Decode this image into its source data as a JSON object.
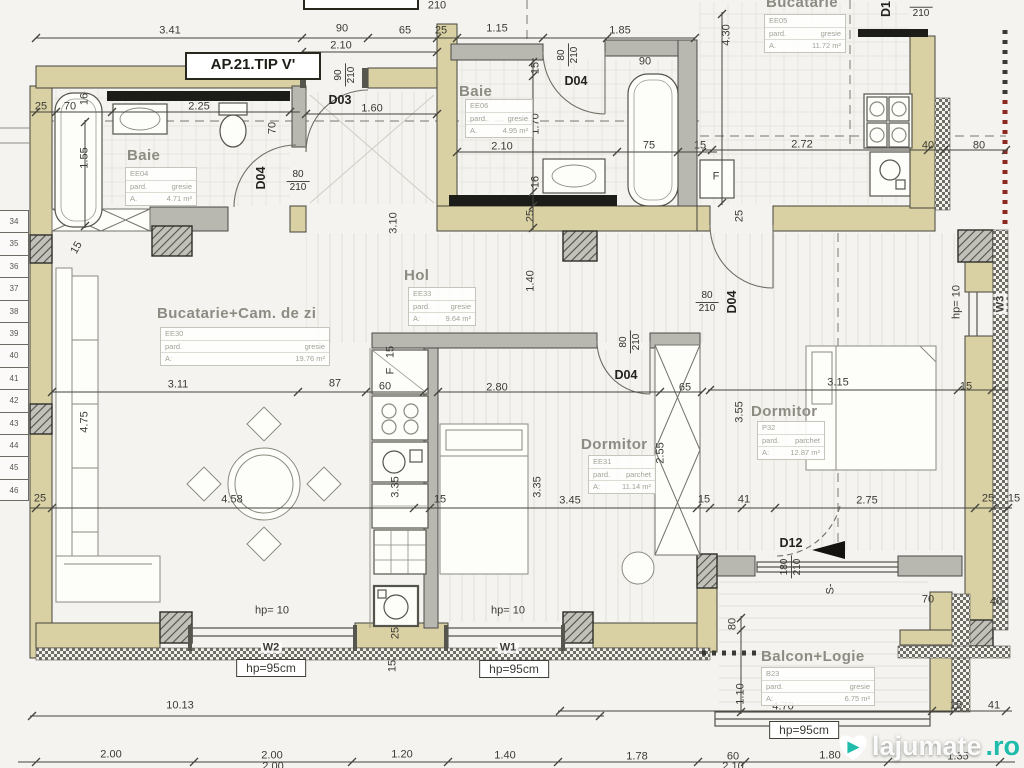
{
  "title": "AP.21.TIP V'",
  "watermark": {
    "name": "lajumate",
    "tld": ".ro"
  },
  "colors": {
    "wall_fill": "#d9d1a3",
    "line": "#44433c",
    "boundary_red": "#8d2721",
    "watermark_teal": "#1fbcab",
    "counter_black": "#1c1c18"
  },
  "rooms": [
    {
      "name": "Baie",
      "code": "EE04",
      "finish_label": "pard.",
      "finish": "gresie",
      "area_label": "A.",
      "area": "4.71 m²",
      "name_x": 127,
      "name_y": 147,
      "box_x": 125,
      "box_y": 167,
      "box_w": 70
    },
    {
      "name": "Baie",
      "code": "EE06",
      "finish_label": "pard.",
      "finish": "gresie",
      "area_label": "A.",
      "area": "4.95 m²",
      "name_x": 459,
      "name_y": 83,
      "box_x": 465,
      "box_y": 99,
      "box_w": 66
    },
    {
      "name": "Bucatarie",
      "code": "EE05",
      "finish_label": "pard.",
      "finish": "gresie",
      "area_label": "A.",
      "area": "11.72 m²",
      "name_x": 766,
      "name_y": -6,
      "box_x": 764,
      "box_y": 14,
      "box_w": 80
    },
    {
      "name": "Bucatarie+Cam. de zi",
      "code": "EE30",
      "finish_label": "pard.",
      "finish": "gresie",
      "area_label": "A:",
      "area": "19.76 m²",
      "name_x": 157,
      "name_y": 305,
      "box_x": 160,
      "box_y": 327,
      "box_w": 168
    },
    {
      "name": "Hol",
      "code": "EE33",
      "finish_label": "pard.",
      "finish": "gresie",
      "area_label": "A:",
      "area": "9.64 m²",
      "name_x": 404,
      "name_y": 267,
      "box_x": 408,
      "box_y": 287,
      "box_w": 66
    },
    {
      "name": "Dormitor",
      "code": "EE31",
      "finish_label": "pard.",
      "finish": "parchet",
      "area_label": "A:",
      "area": "11.14 m²",
      "name_x": 581,
      "name_y": 436,
      "box_x": 588,
      "box_y": 455,
      "box_w": 66
    },
    {
      "name": "Dormitor",
      "code": "P32",
      "finish_label": "pard.",
      "finish": "parchet",
      "area_label": "A:",
      "area": "12.87 m²",
      "name_x": 751,
      "name_y": 403,
      "box_x": 757,
      "box_y": 421,
      "box_w": 66
    },
    {
      "name": "Balcon+Logie",
      "code": "B23",
      "finish_label": "pard.",
      "finish": "gresie",
      "area_label": "A:",
      "area": "6.75 m²",
      "name_x": 761,
      "name_y": 648,
      "box_x": 761,
      "box_y": 667,
      "box_w": 112
    }
  ],
  "doors": [
    {
      "id": "D03",
      "size": "90/210",
      "label_x": 340,
      "label_y": 100,
      "label_r": 0,
      "frac_x": 345,
      "frac_y": 75,
      "frac_r": -90
    },
    {
      "id": "D04",
      "size": "80/210",
      "label_x": 261,
      "label_y": 178,
      "label_r": -90,
      "frac_x": 298,
      "frac_y": 181,
      "frac_r": 0
    },
    {
      "id": "D04",
      "size": "80/210",
      "label_x": 576,
      "label_y": 81,
      "label_r": 0,
      "frac_x": 568,
      "frac_y": 55,
      "frac_r": -90
    },
    {
      "id": "D04",
      "size": "80/210",
      "label_x": 626,
      "label_y": 375,
      "label_r": 0,
      "frac_x": 630,
      "frac_y": 342,
      "frac_r": -90
    },
    {
      "id": "D04",
      "size": "80/210",
      "label_x": 732,
      "label_y": 302,
      "label_r": -90,
      "frac_x": 707,
      "frac_y": 302,
      "frac_r": 0
    },
    {
      "id": "D12",
      "size": "180/210",
      "label_x": 791,
      "label_y": 543,
      "label_r": 0,
      "frac_x": 791,
      "frac_y": 567,
      "frac_r": -90
    },
    {
      "id": "D1",
      "size": "210",
      "label_x": 886,
      "label_y": 9,
      "label_r": -90,
      "frac_x": 921,
      "frac_y": 8,
      "frac_r": 0
    }
  ],
  "dims": [
    [
      "3.41",
      170,
      31
    ],
    [
      "90",
      342,
      29
    ],
    [
      "2.10",
      341,
      46
    ],
    [
      "65",
      405,
      31
    ],
    [
      "25",
      441,
      31
    ],
    [
      "1.15",
      497,
      29
    ],
    [
      "1.85",
      620,
      31
    ],
    [
      "210",
      437,
      6
    ],
    [
      "4.30",
      727,
      35,
      -90
    ],
    [
      "25",
      41,
      107
    ],
    [
      "70",
      70,
      107
    ],
    [
      "16",
      85,
      99,
      -90
    ],
    [
      "2.25",
      199,
      107
    ],
    [
      "70",
      273,
      128,
      -90
    ],
    [
      "1.60",
      372,
      109
    ],
    [
      "1.55",
      85,
      158,
      -90
    ],
    [
      "3.10",
      394,
      223,
      -90
    ],
    [
      "15",
      536,
      68,
      -90
    ],
    [
      "90",
      645,
      62
    ],
    [
      "1.70",
      536,
      124,
      -90
    ],
    [
      "2.10",
      502,
      147
    ],
    [
      "75",
      649,
      146
    ],
    [
      "15",
      700,
      146
    ],
    [
      "16",
      536,
      182,
      -90
    ],
    [
      "25",
      531,
      216,
      -90
    ],
    [
      "F",
      716,
      177
    ],
    [
      "25",
      740,
      216,
      -90
    ],
    [
      "2.72",
      802,
      145
    ],
    [
      "40",
      928,
      146
    ],
    [
      "80",
      979,
      146
    ],
    [
      "1.40",
      531,
      281,
      -90
    ],
    [
      "3.11",
      178,
      385
    ],
    [
      "87",
      335,
      384
    ],
    [
      "60",
      385,
      387
    ],
    [
      "15",
      391,
      352,
      -90
    ],
    [
      "F",
      391,
      371,
      -90
    ],
    [
      "2.80",
      497,
      388
    ],
    [
      "65",
      685,
      388
    ],
    [
      "3.15",
      838,
      383
    ],
    [
      "15",
      966,
      387
    ],
    [
      "3.55",
      740,
      412,
      -90
    ],
    [
      "2.55",
      661,
      453,
      -90
    ],
    [
      "4.75",
      85,
      422,
      -90
    ],
    [
      "15",
      77,
      248,
      -60
    ],
    [
      "25",
      40,
      499
    ],
    [
      "4.58",
      232,
      500
    ],
    [
      "3.35",
      396,
      487,
      -90
    ],
    [
      "15",
      440,
      500
    ],
    [
      "3.35",
      538,
      487,
      -90
    ],
    [
      "3.45",
      570,
      501
    ],
    [
      "15",
      704,
      500
    ],
    [
      "41",
      744,
      500
    ],
    [
      "2.75",
      867,
      501
    ],
    [
      "25",
      988,
      499
    ],
    [
      "15",
      1014,
      499
    ],
    [
      "hp= 10",
      272,
      611
    ],
    [
      "hp= 10",
      508,
      611
    ],
    [
      "hp= 10",
      957,
      302,
      -90
    ],
    [
      "70",
      928,
      600
    ],
    [
      "40",
      996,
      602
    ],
    [
      "S-",
      831,
      589,
      -90
    ],
    [
      "80",
      733,
      624,
      -90
    ],
    [
      "1.10",
      741,
      694,
      -90
    ],
    [
      "4.70",
      783,
      707
    ],
    [
      "15",
      956,
      706
    ],
    [
      "41",
      994,
      706
    ],
    [
      "25",
      396,
      633,
      -90
    ],
    [
      "15",
      393,
      666,
      -90
    ],
    [
      "10.13",
      180,
      706
    ],
    [
      "2.00",
      111,
      755
    ],
    [
      "2.00",
      272,
      756
    ],
    [
      "1.20",
      402,
      755
    ],
    [
      "1.40",
      505,
      756
    ],
    [
      "1.78",
      637,
      757
    ],
    [
      "60",
      733,
      757
    ],
    [
      "1.80",
      830,
      756
    ],
    [
      "1.35",
      958,
      757
    ],
    [
      "2.00",
      273,
      767
    ],
    [
      "2.10",
      733,
      767
    ]
  ],
  "window_labels": [
    [
      "W2",
      271,
      648,
      0
    ],
    [
      "W1",
      508,
      648,
      0
    ],
    [
      "W3",
      1001,
      304,
      -90
    ]
  ],
  "hp_boxes": {
    "text": "hp=95cm",
    "positions": [
      [
        271,
        668
      ],
      [
        514,
        669
      ],
      [
        804,
        730
      ]
    ]
  },
  "stair_numbers": [
    "34",
    "35",
    "36",
    "37",
    "38",
    "39",
    "40",
    "41",
    "42",
    "43",
    "44",
    "45",
    "46"
  ]
}
